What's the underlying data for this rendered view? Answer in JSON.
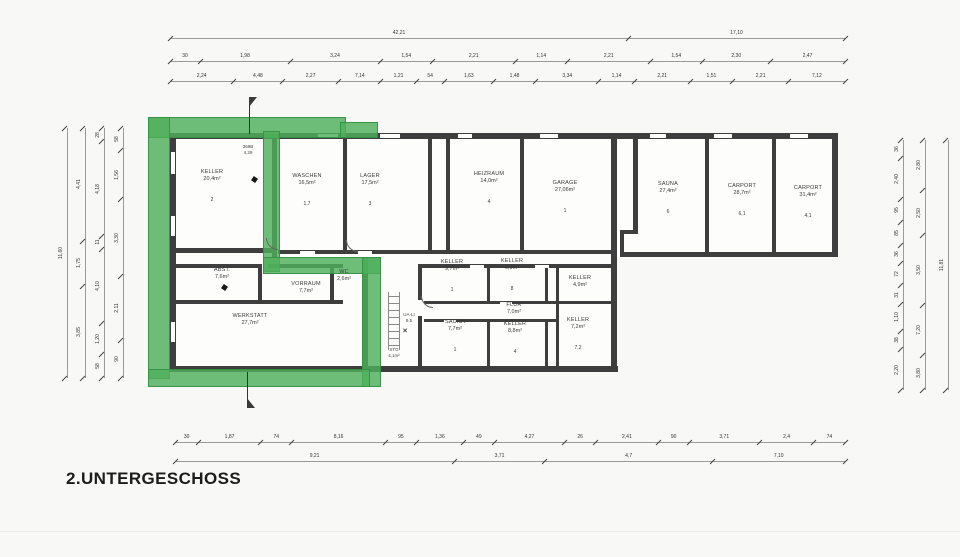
{
  "title": "2.UNTERGESCHOSS",
  "colors": {
    "highlight_green": "#4eb05c",
    "highlight_border": "#348f42",
    "wall": "#3e3e3e",
    "dimension_line": "#9a9a9a",
    "text": "#3a3a3a"
  },
  "rooms": [
    {
      "name": "KELLER",
      "area": "20,4m²",
      "num": "2",
      "x": 212,
      "y": 186
    },
    {
      "name": "WASCHEN",
      "area": "16,5m²",
      "num": "1,7",
      "x": 307,
      "y": 190
    },
    {
      "name": "LAGER",
      "area": "17,5m²",
      "num": "3",
      "x": 370,
      "y": 190
    },
    {
      "name": "HEIZRAUM",
      "area": "14,0m²",
      "num": "4",
      "x": 489,
      "y": 188
    },
    {
      "name": "GARAGE",
      "area": "27,06m²",
      "num": "1",
      "x": 565,
      "y": 197
    },
    {
      "name": "SAUNA",
      "area": "27,4m²",
      "num": "6",
      "x": 668,
      "y": 198
    },
    {
      "name": "CARPORT",
      "area": "28,7m²",
      "num": "6,1",
      "x": 742,
      "y": 200
    },
    {
      "name": "CARPORT",
      "area": "31,4m²",
      "num": "4,1",
      "x": 808,
      "y": 202
    },
    {
      "name": "ABST.",
      "area": "7,6m²",
      "num": null,
      "x": 222,
      "y": 274
    },
    {
      "name": "VORRAUM",
      "area": "7,7m²",
      "num": null,
      "x": 306,
      "y": 288
    },
    {
      "name": "WC",
      "area": "2,6m²",
      "num": null,
      "x": 344,
      "y": 276
    },
    {
      "name": "WERKSTATT",
      "area": "27,7m²",
      "num": null,
      "x": 250,
      "y": 320
    },
    {
      "name": "KELLER",
      "area": "9,7m²",
      "num": "1",
      "x": 452,
      "y": 276
    },
    {
      "name": "KELLER",
      "area": "9,9m²",
      "num": "8",
      "x": 512,
      "y": 275
    },
    {
      "name": "KELLER",
      "area": "4,9m²",
      "num": null,
      "x": 580,
      "y": 282
    },
    {
      "name": "FLUR",
      "area": "7,0m²",
      "num": null,
      "x": 514,
      "y": 309
    },
    {
      "name": "SAUNA",
      "area": "7,7m²",
      "num": "1",
      "x": 455,
      "y": 336
    },
    {
      "name": "KELLER",
      "area": "8,8m²",
      "num": "4",
      "x": 515,
      "y": 338
    },
    {
      "name": "KELLER",
      "area": "7,2m²",
      "num": "7,2",
      "x": 578,
      "y": 334
    }
  ],
  "small_labels": [
    {
      "lines": [
        "369B",
        "4,29"
      ],
      "x": 248,
      "y": 150
    },
    {
      "lines": [
        "UA-LI",
        "9,5"
      ],
      "x": 409,
      "y": 318
    },
    {
      "lines": [
        "STG",
        "4,1m²"
      ],
      "x": 394,
      "y": 353
    }
  ],
  "dim_chains": [
    {
      "orient": "h",
      "x": 170,
      "y": 33,
      "len": 675,
      "segs": [
        [
          "42,21",
          57
        ],
        [
          "17,10",
          27
        ]
      ]
    },
    {
      "orient": "h",
      "x": 170,
      "y": 56,
      "len": 675,
      "segs": [
        [
          "30",
          4
        ],
        [
          "1,98",
          12
        ],
        [
          "3,24",
          12
        ],
        [
          "1,54",
          7
        ],
        [
          "2,21",
          11
        ],
        [
          "1,14",
          7
        ],
        [
          "2,21",
          11
        ],
        [
          "1,54",
          7
        ],
        [
          "2,30",
          9
        ],
        [
          "2,47",
          10
        ]
      ]
    },
    {
      "orient": "h",
      "x": 170,
      "y": 76,
      "len": 675,
      "segs": [
        [
          "2,24",
          9
        ],
        [
          "4,48",
          7
        ],
        [
          "2,27",
          8
        ],
        [
          "7,14",
          6
        ],
        [
          "1,21",
          5
        ],
        [
          "54",
          4
        ],
        [
          "1,63",
          7
        ],
        [
          "1,48",
          6
        ],
        [
          "3,34",
          9
        ],
        [
          "1,14",
          5
        ],
        [
          "2,21",
          8
        ],
        [
          "1,51",
          6
        ],
        [
          "2,21",
          8
        ],
        [
          "7,12",
          8
        ]
      ]
    },
    {
      "orient": "h",
      "x": 175,
      "y": 437,
      "len": 670,
      "segs": [
        [
          "30",
          3
        ],
        [
          "1,87",
          8
        ],
        [
          "74",
          4
        ],
        [
          "8,16",
          12
        ],
        [
          "95",
          4
        ],
        [
          "1,36",
          6
        ],
        [
          "49",
          4
        ],
        [
          "4,27",
          9
        ],
        [
          "26",
          4
        ],
        [
          "2,41",
          8
        ],
        [
          "90",
          4
        ],
        [
          "3,71",
          9
        ],
        [
          "2,4",
          7
        ],
        [
          "74",
          4
        ]
      ]
    },
    {
      "orient": "h",
      "x": 175,
      "y": 456,
      "len": 670,
      "segs": [
        [
          "9,21",
          40
        ],
        [
          "3,71",
          13
        ],
        [
          "4,7",
          24
        ],
        [
          "7,10",
          19
        ]
      ]
    },
    {
      "orient": "v",
      "x": 62,
      "y": 128,
      "len": 250,
      "segs": [
        [
          "11,60",
          1
        ]
      ]
    },
    {
      "orient": "v",
      "x": 80,
      "y": 128,
      "len": 250,
      "segs": [
        [
          "4,41",
          45
        ],
        [
          "1,75",
          18
        ],
        [
          "3,85",
          37
        ]
      ]
    },
    {
      "orient": "v",
      "x": 99,
      "y": 128,
      "len": 250,
      "segs": [
        [
          "28",
          5
        ],
        [
          "4,18",
          36
        ],
        [
          "11",
          5
        ],
        [
          "4,10",
          28
        ],
        [
          "1,20",
          12
        ],
        [
          "58",
          9
        ]
      ]
    },
    {
      "orient": "v",
      "x": 118,
      "y": 128,
      "len": 250,
      "segs": [
        [
          "58",
          8
        ],
        [
          "1,56",
          18
        ],
        [
          "3,30",
          28
        ],
        [
          "2,11",
          23
        ],
        [
          "90",
          14
        ]
      ]
    },
    {
      "orient": "v",
      "x": 898,
      "y": 140,
      "len": 250,
      "segs": [
        [
          "36",
          4
        ],
        [
          "2,40",
          9
        ],
        [
          "95",
          5
        ],
        [
          "85",
          5
        ],
        [
          "36",
          4
        ],
        [
          "72",
          5
        ],
        [
          "31",
          4
        ],
        [
          "1,10",
          6
        ],
        [
          "38",
          4
        ],
        [
          "2,20",
          9
        ]
      ]
    },
    {
      "orient": "v",
      "x": 920,
      "y": 140,
      "len": 250,
      "segs": [
        [
          "2,80",
          20
        ],
        [
          "2,50",
          18
        ],
        [
          "3,50",
          28
        ],
        [
          "7,20",
          20
        ],
        [
          "3,80",
          14
        ]
      ]
    },
    {
      "orient": "v",
      "x": 943,
      "y": 140,
      "len": 250,
      "segs": [
        [
          "11,81",
          1
        ]
      ]
    }
  ]
}
